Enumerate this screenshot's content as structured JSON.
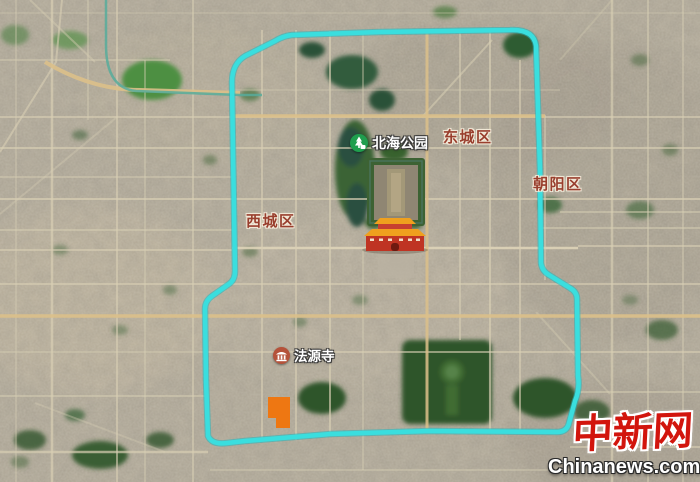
{
  "map": {
    "districts": [
      {
        "name": "dongcheng",
        "text": "东城区"
      },
      {
        "name": "xicheng",
        "text": "西城区"
      },
      {
        "name": "chaoyang",
        "text": "朝阳区"
      }
    ],
    "pois": [
      {
        "name": "beihai-park",
        "text": "北海公园"
      },
      {
        "name": "fayuan-temple",
        "text": "法源寺"
      }
    ],
    "route_color": "#3ADEDE",
    "highlight_color": "#EE7712",
    "label_color": "#993F2E"
  },
  "watermark": {
    "logo": "中新网",
    "site": "Chinanews.com",
    "logo_color": "#D2150D"
  }
}
